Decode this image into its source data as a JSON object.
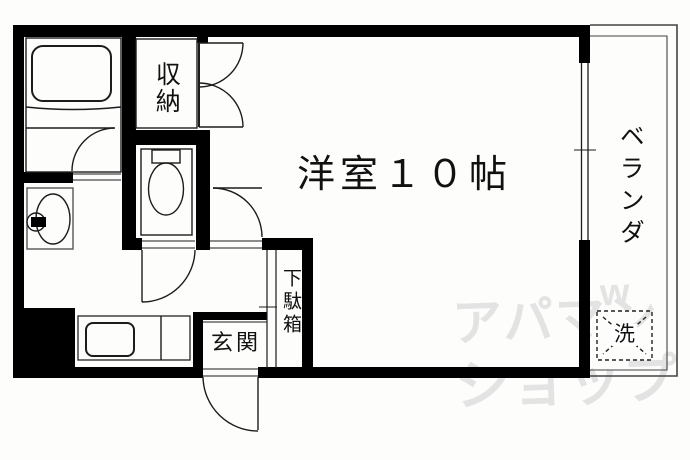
{
  "title": "1K apartment floor plan",
  "rooms": {
    "main_room": "洋室１０帖",
    "storage": "収納",
    "veranda": "ベランダ",
    "entrance": "玄関",
    "shoe_cabinet": "下駄箱",
    "washer": "洗"
  },
  "watermark": {
    "line1": "アパマン",
    "line2": "ショップ",
    "mark": "w"
  },
  "colors": {
    "wall": "#000000",
    "line": "#1c1c1c",
    "fixture_line": "#3f3f3f",
    "watermark": "#e3e3e3",
    "background": "#fdfdfc"
  }
}
